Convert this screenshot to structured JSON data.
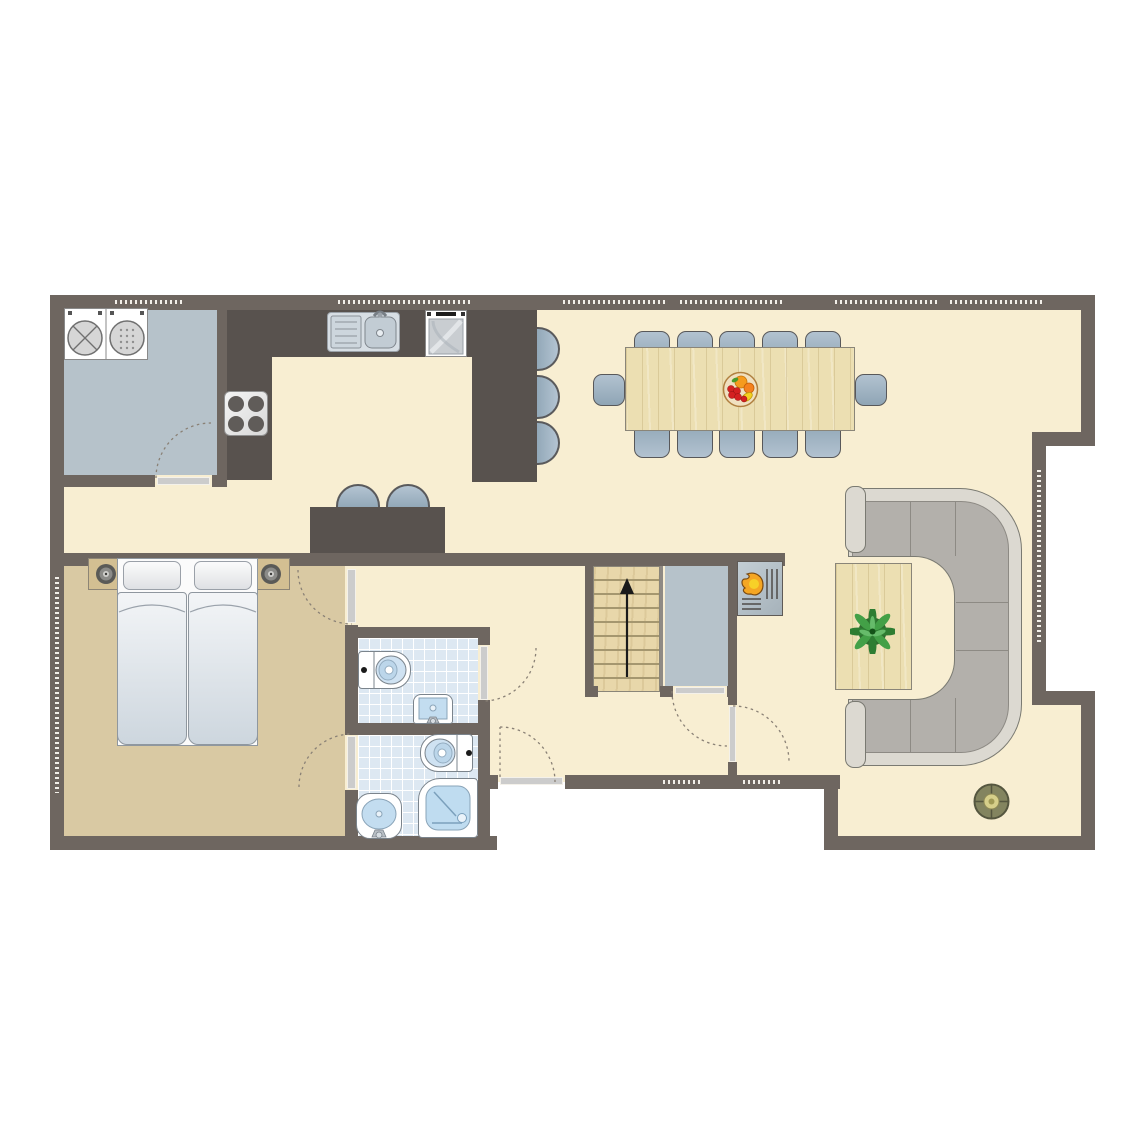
{
  "document": {
    "type": "residential floor plan (ground floor), top-down architectural drawing",
    "text_labels": "none visible in drawing",
    "palette": {
      "exterior": "#ffffff",
      "walls": "#6e6660",
      "living_floor": "#f8eed2",
      "bedroom_floor": "#d9c9a3",
      "utility_floor": "#b6c2ca",
      "bathroom_tile": "#dde8f2",
      "kitchen_counter": "#4d4744",
      "wood_furniture": "#ecdfb2",
      "seat_upholstery": "#9fb3c2",
      "sofa_cushion": "#b3b0ab",
      "window_dashes": "#f2efe9",
      "door_threshold": "#cccccc",
      "flame": "#f5a623",
      "plant": "#3d9140"
    },
    "rooms": [
      {
        "name": "utility-room",
        "position": "top-left",
        "furniture": [
          "washing-machine",
          "tumble-dryer"
        ],
        "doors": 1
      },
      {
        "name": "kitchen",
        "position": "top",
        "furniture": [
          "l-shaped-dark-counter",
          "sink-with-drainboard",
          "oven",
          "hob-4-burners",
          "peninsula-counter",
          "island-counter"
        ],
        "bar_stools_peninsula": 3,
        "bar_stools_island": 2
      },
      {
        "name": "dining-area",
        "position": "top-center",
        "furniture": [
          "rectangular-wood-table",
          "fruit-bowl"
        ],
        "chairs": 12
      },
      {
        "name": "living-area",
        "position": "right",
        "furniture": [
          "c-shaped-sectional-sofa",
          "wood-coffee-table",
          "potted-plant",
          "round-floor-lamp",
          "fireplace"
        ]
      },
      {
        "name": "hallway",
        "position": "center-bottom",
        "features": [
          "main-entrance-door",
          "two-windows-bottom-wall"
        ]
      },
      {
        "name": "staircase",
        "position": "center",
        "features": [
          "8-treads",
          "up-arrow"
        ]
      },
      {
        "name": "storage-closet",
        "position": "center, beside stairs",
        "doors": 1
      },
      {
        "name": "bedroom",
        "position": "left-bottom",
        "furniture": [
          "double-bed-two-mattresses",
          "two-pillows",
          "two-nightstands-with-lamps"
        ],
        "doors": 2
      },
      {
        "name": "bathroom-wc",
        "position": "center-left",
        "furniture": [
          "toilet",
          "washbasin"
        ],
        "doors": 1
      },
      {
        "name": "bathroom-shower",
        "position": "center-left-bottom",
        "furniture": [
          "toilet",
          "washbasin",
          "corner-shower"
        ],
        "doors": 1
      }
    ],
    "openings": {
      "window_strips_top_wall": 6,
      "window_left_wall": 1,
      "window_right_notch_wall": 1,
      "windows_hall_bottom_wall": 2,
      "door_swings_dashed": 7
    },
    "footprint": "rectangular with a notch cut into the middle of the right side"
  }
}
